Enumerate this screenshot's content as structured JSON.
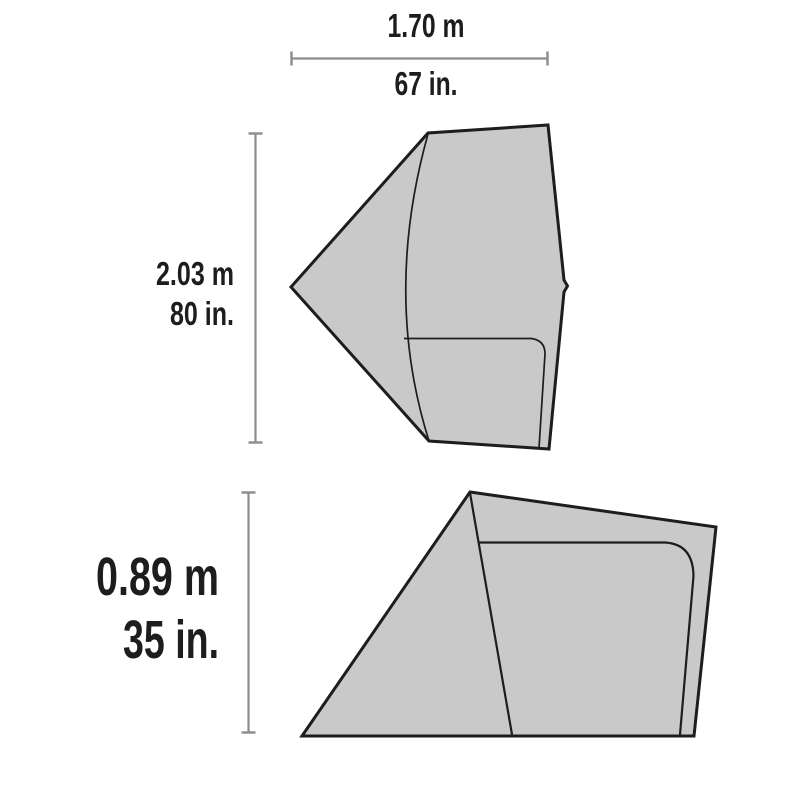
{
  "diagram": {
    "subject": "Tent specification dimension drawing (top view and side view)",
    "background": "#ffffff",
    "colors": {
      "panel_fill": "#c9c9c9",
      "outline": "#1d1d1b",
      "seam_line": "#1d1d1b",
      "dimension_line": "#8c8c8c",
      "label_text": "#1d1d1b"
    },
    "views": {
      "top_view": {
        "name": "Top (floor plan) view of tent"
      },
      "side_view": {
        "name": "Side profile view of tent"
      }
    },
    "dimensions": {
      "width": {
        "metric": "1.70 m",
        "imperial": "67 in."
      },
      "length": {
        "metric": "2.03 m",
        "imperial": "80 in."
      },
      "height": {
        "metric": "0.89 m",
        "imperial": "35 in."
      }
    }
  }
}
